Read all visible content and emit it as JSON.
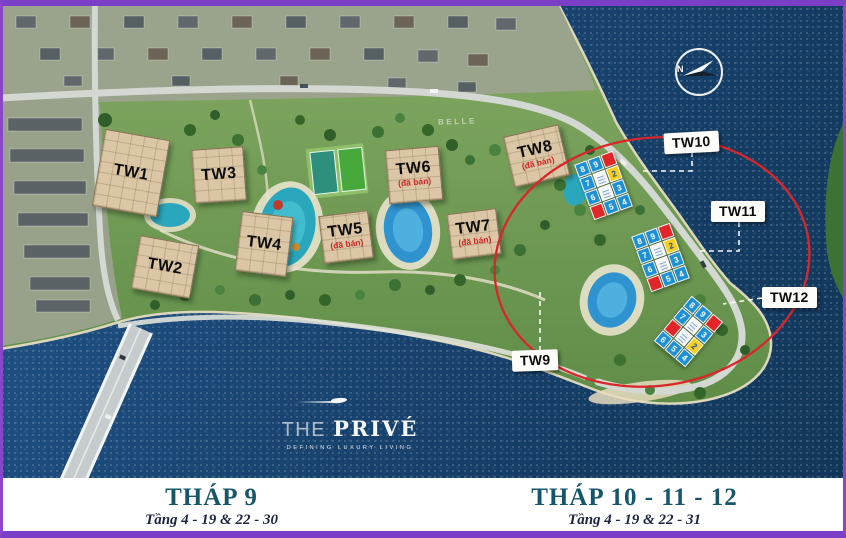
{
  "compass": {
    "label": "N"
  },
  "watermark": {
    "the": "THE",
    "prive": "PRIVÉ",
    "tagline": "DEFINING LUXURY LIVING"
  },
  "site_label": {
    "text": "BELLE"
  },
  "towers": [
    {
      "id": "tw1",
      "label": "TW1",
      "status": ""
    },
    {
      "id": "tw2",
      "label": "TW2",
      "status": ""
    },
    {
      "id": "tw3",
      "label": "TW3",
      "status": ""
    },
    {
      "id": "tw4",
      "label": "TW4",
      "status": ""
    },
    {
      "id": "tw5",
      "label": "TW5",
      "status": "(đã bán)"
    },
    {
      "id": "tw6",
      "label": "TW6",
      "status": "(đã bán)"
    },
    {
      "id": "tw7",
      "label": "TW7",
      "status": "(đã bán)"
    },
    {
      "id": "tw8",
      "label": "TW8",
      "status": "(đã bán)"
    }
  ],
  "callouts": [
    {
      "id": "tw10",
      "label": "TW10"
    },
    {
      "id": "tw11",
      "label": "TW11"
    },
    {
      "id": "tw12",
      "label": "TW12"
    },
    {
      "id": "tw9",
      "label": "TW9"
    }
  ],
  "unit_grids": {
    "tw10": {
      "cells": [
        {
          "v": "8",
          "c": "blue"
        },
        {
          "v": "9",
          "c": "blue"
        },
        {
          "v": "",
          "c": "red"
        },
        {
          "v": "7",
          "c": "blue"
        },
        {
          "v": "",
          "c": "core"
        },
        {
          "v": "2",
          "c": "yellow"
        },
        {
          "v": "6",
          "c": "blue"
        },
        {
          "v": "",
          "c": "core"
        },
        {
          "v": "3",
          "c": "blue"
        },
        {
          "v": "",
          "c": "red"
        },
        {
          "v": "5",
          "c": "blue"
        },
        {
          "v": "4",
          "c": "blue"
        }
      ]
    },
    "tw11": {
      "cells": [
        {
          "v": "8",
          "c": "blue"
        },
        {
          "v": "9",
          "c": "blue"
        },
        {
          "v": "",
          "c": "red"
        },
        {
          "v": "7",
          "c": "blue"
        },
        {
          "v": "",
          "c": "core"
        },
        {
          "v": "2",
          "c": "yellow"
        },
        {
          "v": "6",
          "c": "blue"
        },
        {
          "v": "",
          "c": "core"
        },
        {
          "v": "3",
          "c": "blue"
        },
        {
          "v": "",
          "c": "red"
        },
        {
          "v": "5",
          "c": "blue"
        },
        {
          "v": "4",
          "c": "blue"
        }
      ]
    },
    "tw12": {
      "cells": [
        {
          "v": "8",
          "c": "blue"
        },
        {
          "v": "9",
          "c": "blue"
        },
        {
          "v": "",
          "c": "red"
        },
        {
          "v": "7",
          "c": "blue"
        },
        {
          "v": "",
          "c": "core"
        },
        {
          "v": "3",
          "c": "blue"
        },
        {
          "v": "",
          "c": "red"
        },
        {
          "v": "",
          "c": "core"
        },
        {
          "v": "2",
          "c": "yellow"
        },
        {
          "v": "6",
          "c": "blue"
        },
        {
          "v": "5",
          "c": "blue"
        },
        {
          "v": "4",
          "c": "blue"
        }
      ]
    }
  },
  "footer": {
    "left": {
      "title": "THÁP 9",
      "subtitle": "Tầng 4 - 19 & 22 - 30"
    },
    "right": {
      "title": "THÁP 10 - 11 - 12",
      "subtitle": "Tầng 4 - 19 & 22 - 31"
    }
  },
  "colors": {
    "frame_purple": "#7b3ec6",
    "highlight_ellipse": "#d8262b",
    "sold_text": "#cf2626",
    "footer_title_teal": "#15566b",
    "water_blue": "#1a4674",
    "unit_blue": "#1e90d6",
    "unit_red": "#e02629",
    "unit_yellow": "#f7d021"
  }
}
